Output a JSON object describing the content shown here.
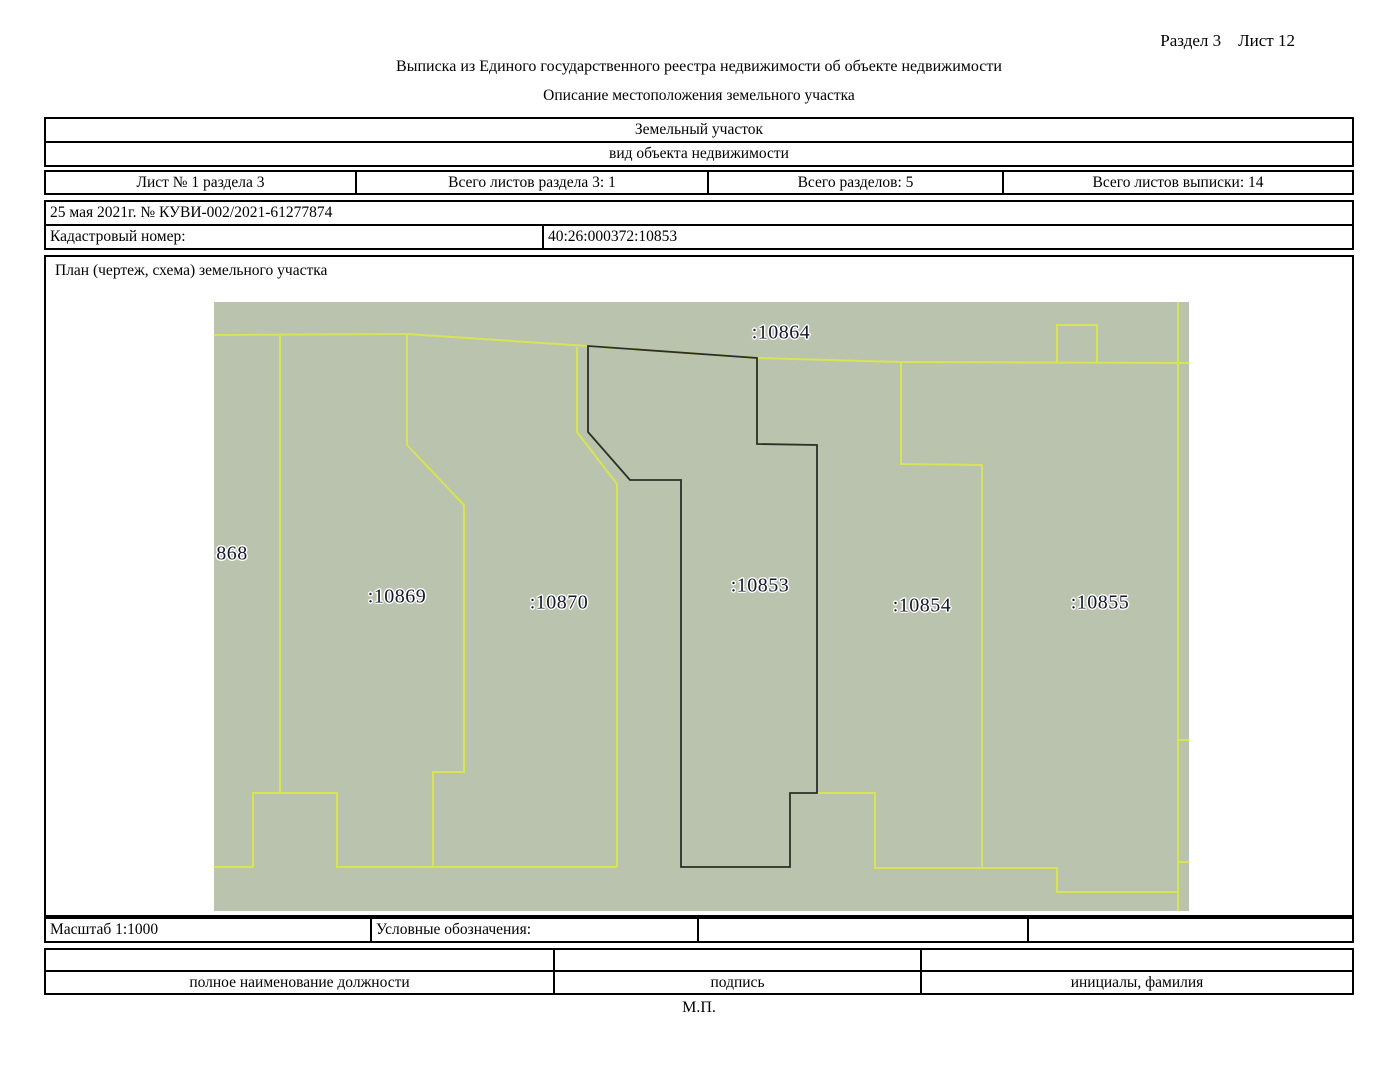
{
  "page": {
    "corner": "Раздел 3    Лист 12",
    "title": "Выписка из Единого государственного реестра недвижимости об объекте недвижимости",
    "subtitle": "Описание местоположения земельного участка"
  },
  "object_table": {
    "object_type": "Земельный участок",
    "object_type_caption": "вид объекта недвижимости",
    "sheet_info": [
      "Лист № 1 раздела 3",
      "Всего листов раздела 3: 1",
      "Всего разделов: 5",
      "Всего листов выписки: 14"
    ],
    "date_number": "25 мая 2021г. № КУВИ-002/2021-61277874",
    "cadastral_label": "Кадастровый номер:",
    "cadastral_value": "40:26:000372:10853"
  },
  "plan": {
    "title": "План (чертеж, схема) земельного участка",
    "scale_label": "Масштаб 1:1000",
    "legend_label": "Условные обозначения:",
    "map": {
      "background_color": "#b9c3ad",
      "parcel_line_color": "#d7e455",
      "subject_line_color": "#2b3026",
      "labels": [
        {
          "text": ":10864",
          "x": 567,
          "y": 31
        },
        {
          "text": "868",
          "x": 18,
          "y": 252
        },
        {
          "text": ":10869",
          "x": 183,
          "y": 295
        },
        {
          "text": ":10870",
          "x": 345,
          "y": 301
        },
        {
          "text": ":10853",
          "x": 546,
          "y": 284
        },
        {
          "text": ":10854",
          "x": 708,
          "y": 304
        },
        {
          "text": ":10855",
          "x": 886,
          "y": 301
        }
      ]
    }
  },
  "signature_table": {
    "columns": [
      "полное наименование должности",
      "подпись",
      "инициалы, фамилия"
    ],
    "stamp": "М.П."
  }
}
